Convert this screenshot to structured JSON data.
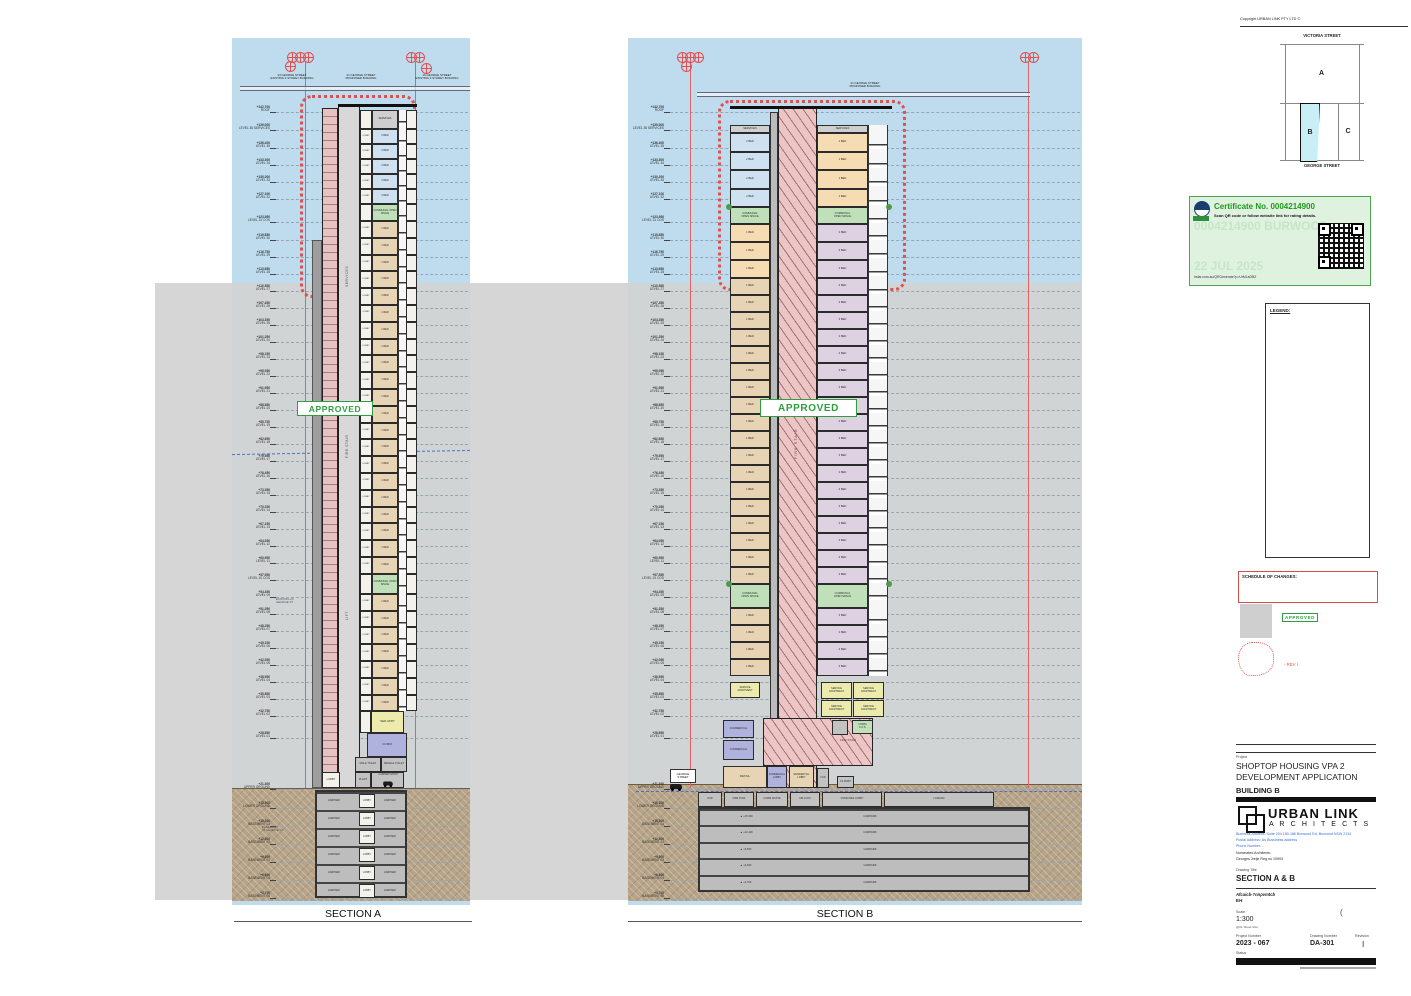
{
  "colors": {
    "approved_green": "#2f9e3f",
    "cert_green": "#1a9c1a",
    "revision_red": "#e0504f",
    "sky": "#bedced",
    "adg_blue": "#5577cc",
    "as1428_red": "#cc4444",
    "solar_orange": "#e8892a"
  },
  "copyright": "Copyright URBAN LINK PTY LTD ©",
  "key_plan": {
    "top_street": "VICTORIA STREET",
    "bottom_street": "GEORGE STREET",
    "block_a": "A",
    "block_b": "B",
    "block_c": "C"
  },
  "certificate": {
    "title": "Certificate No. 0004214900",
    "subtitle": "Scan QR code or follow website link for rating details.",
    "fields": [
      {
        "label": "Assessor name",
        "value": "John Boutros"
      },
      {
        "label": "Accreditation No.",
        "value": "DMN/16/1763"
      },
      {
        "label": "Property Address",
        "value": "28-34 Victoria St,Burwood"
      },
      {
        "label": "",
        "value": "NSW,2134"
      }
    ],
    "link": "hstar.com.au/QRGenerate?p=UrMLaDBZ",
    "watermark1": "0004214900 BURWOOD",
    "watermark2": "22 JUL 2025"
  },
  "legend": {
    "title": "LEGEND:",
    "abbrev": [
      [
        "ELECT",
        "ELECTRICAL CUPBOARD"
      ],
      [
        "ELECT & EV",
        "ELECTRICAL AND\nELECTRIC VEHICLE CUPBOARD"
      ],
      [
        "PRE",
        "PUMP ROOM EXHAUST"
      ],
      [
        "SP",
        "STAIR PRESS"
      ],
      [
        "KE",
        "KITCHEN EXHAUST"
      ],
      [
        "EXH",
        "EXHAUST"
      ],
      [
        "HYD",
        "HYDRAULIC CUPBOARD"
      ],
      [
        "COMMS",
        "COMMUNICATIONS CUPBOARD"
      ],
      [
        "CPE",
        "CAR PARK EXHAUST"
      ],
      [
        "CPS",
        "CAR PARK SUPPLY"
      ],
      [
        "AC",
        "AIR CONDITIONER"
      ],
      [
        "RESI",
        "RESIDENTIAL"
      ],
      [
        "COMM",
        "COMMERCIAL"
      ],
      [
        "SA",
        "SERVICED APARTMENTS"
      ],
      [
        "OSD",
        "ON SITE STORMWATER\nDETENTION"
      ],
      [
        "SRV",
        "SMALL RIGID VEHICLE"
      ],
      [
        "FCR",
        "FIRE CONTROL ROOM"
      ],
      [
        "GC",
        "GARBAGE CHUTE"
      ],
      [
        "SER APRT",
        "SERVICED APARTMENT"
      ],
      [
        "F",
        "FRIDGE"
      ],
      [
        "W",
        "WASHER"
      ],
      [
        "COS",
        "COMMUNAL OPEN SPACE"
      ],
      [
        "HW PLANT",
        "HOT WATER PLANT"
      ]
    ],
    "symbols": [
      [
        "laundry-tub-icon",
        "LAUNDRY TUB"
      ],
      [
        "adaptable-apartment-icon",
        "ADAPTABLE APARTMENT"
      ],
      [
        "liveable-apartment-icon",
        "LIVEABLE APARTMENT"
      ],
      [
        "adg-compliance-icon",
        "ADG COMPLIANCE\nDIMENSIONS"
      ],
      [
        "as1428-circulation-icon",
        "AS 1428.1 CIRCULATION\nDIMENSIONS"
      ],
      [
        "solar-access-icon",
        "SOLAR ACCESS MIN 2 HOURS"
      ]
    ]
  },
  "schedule": {
    "title": "SCHEDULE OF CHANGES:",
    "items": [
      "- AMENDED UNIT MIX.",
      "- COS RELOCATED TO LEVEL 31."
    ],
    "approved": "APPROVED",
    "rev_note": "-  REV I"
  },
  "revisions": {
    "headers": [
      "Rev",
      "Description",
      "Date",
      "App'd"
    ],
    "rows": [
      [
        "I",
        "VPA 2 SUBMISSION",
        "16/07/2025",
        "GJ"
      ],
      [
        "H",
        "VPA 2 SUBMISSION",
        "02/12/2024",
        "JB"
      ],
      [
        "G",
        "SSDA SUBMISSION",
        "23/10/2024",
        "JB"
      ],
      [
        "F",
        "SSDA SUBMISSION",
        "27/08/2024",
        "JB"
      ],
      [
        "E",
        "SSDA SUBMISSION",
        "15/05/2024",
        "JB"
      ],
      [
        "D",
        "SSDA SUBMISSION",
        "03/04/2024",
        "JB"
      ],
      [
        "C",
        "COORDINATION",
        "20/03/2024",
        "JB"
      ],
      [
        "B",
        "SSDA DRP",
        "06/03/2024",
        "JB"
      ],
      [
        "A",
        "SSD BRIEFING",
        "20/12/2023",
        "GJ"
      ]
    ]
  },
  "title_block": {
    "project_label": "Project",
    "project_line1": "SHOPTOP HOUSING VPA 2",
    "project_line2": "DEVELOPMENT APPLICATION",
    "building": "BUILDING B",
    "firm": "URBAN LINK",
    "firm_sub": "A R C H I T E C T S",
    "address1": "Business Address: Suite 204 180-186 Burwood Rd,  Burwood NSW 2134",
    "address2": "Postal Address: As Bussiness address",
    "phone": "Phone Number: -",
    "nominated": "Nominated Architects:",
    "architect": "Georges Jreije Reg no 10993",
    "drawing_title_label": "Drawing Title",
    "drawing_title": "SECTION A & B",
    "code": "Afcaicb-?nnpvmtcb",
    "code2": "EH",
    "scale_label": "Scale",
    "scale": "1:300",
    "sheet_note": "@A1 Sheet Size",
    "bracket": "(",
    "project_number_label": "Project Number",
    "project_number": "2023 - 067",
    "drawing_number_label": "Drawing Number",
    "drawing_number": "DA-301",
    "revision_label": "Revision",
    "revision": "I",
    "status_label": "Status"
  },
  "levels": [
    [
      "+142.700",
      "ROOF",
      112
    ],
    [
      "+139.000",
      "LEVEL 36 SERVICES",
      130
    ],
    [
      "+136.400",
      "LEVEL 35",
      148
    ],
    [
      "+133.300",
      "LEVEL 34",
      165
    ],
    [
      "+130.200",
      "LEVEL 33",
      182
    ],
    [
      "+127.100",
      "LEVEL 32",
      199
    ],
    [
      "+123.950",
      "LEVEL 31 COS",
      222
    ],
    [
      "+119.850",
      "LEVEL 30",
      240
    ],
    [
      "+116.750",
      "LEVEL 29",
      257
    ],
    [
      "+113.650",
      "LEVEL 28",
      274
    ],
    [
      "+110.550",
      "LEVEL 27",
      291
    ],
    [
      "+107.450",
      "LEVEL 26",
      308
    ],
    [
      "+104.350",
      "LEVEL 25",
      325
    ],
    [
      "+101.250",
      "LEVEL 24",
      342
    ],
    [
      "+98.150",
      "LEVEL 23",
      359
    ],
    [
      "+95.050",
      "LEVEL 22",
      376
    ],
    [
      "+91.950",
      "LEVEL 21",
      393
    ],
    [
      "+88.850",
      "LEVEL 20",
      410
    ],
    [
      "+85.750",
      "LEVEL 19",
      427
    ],
    [
      "+82.650",
      "LEVEL 18",
      444
    ],
    [
      "+79.550",
      "LEVEL 17",
      461
    ],
    [
      "+76.450",
      "LEVEL 16",
      478
    ],
    [
      "+73.350",
      "LEVEL 15",
      495
    ],
    [
      "+70.250",
      "LEVEL 14",
      512
    ],
    [
      "+67.150",
      "LEVEL 13",
      529
    ],
    [
      "+64.050",
      "LEVEL 12",
      546
    ],
    [
      "+60.950",
      "LEVEL 11",
      563
    ],
    [
      "+57.550",
      "LEVEL 10 COS",
      580
    ],
    [
      "+54.450",
      "LEVEL 09",
      597
    ],
    [
      "+51.350",
      "LEVEL 08",
      614
    ],
    [
      "+48.250",
      "LEVEL 07",
      631
    ],
    [
      "+45.150",
      "LEVEL 06",
      648
    ],
    [
      "+42.050",
      "LEVEL 05",
      665
    ],
    [
      "+38.950",
      "LEVEL 04",
      682
    ],
    [
      "+35.850",
      "LEVEL 03",
      699
    ],
    [
      "+32.750",
      "LEVEL 02",
      716
    ],
    [
      "+28.850",
      "LEVEL 01",
      738
    ],
    [
      "+21.300",
      "UPPER GROUND",
      789
    ],
    [
      "+18.300",
      "LOWER GROUND",
      808
    ],
    [
      "+15.300",
      "BASEMENT 01",
      826
    ],
    [
      "+12.400",
      "BASEMENT 02",
      844
    ],
    [
      "+9.500",
      "BASEMENT 03",
      862
    ],
    [
      "+6.600",
      "BASEMENT 04",
      880
    ],
    [
      "+3.700",
      "BASEMENT 05",
      898
    ]
  ],
  "section_a": {
    "title": "SECTION A",
    "approved": "APPROVED",
    "street_segments": [
      [
        "23 GEORGE STREET",
        "EXISTING 2 STOREY BUILDING"
      ],
      [
        "21 GEORGE STREET",
        "PROPOSED BUILDING"
      ],
      [
        "19 GEORGE STREET",
        "EXISTING 3 STOREY BUILDING"
      ]
    ],
    "core_labels": [
      "SERVICES",
      "FIRE STAIR",
      "LIFT"
    ],
    "existing_note": "EXISTING 23\nGEORGE ST",
    "basement_note": "BASEMENT\n23 GEORGE ST",
    "floor_bands": [
      {
        "count": 1,
        "h": 19,
        "lobby": "",
        "unit": "SERVICES",
        "type": "svc"
      },
      {
        "count": 5,
        "h": 15,
        "lobby": "LOBBY",
        "unit": "2 BED",
        "type": "blue"
      },
      {
        "count": 1,
        "h": 17,
        "lobby": "",
        "unit": "COMMUNAL OPEN SPACE",
        "type": "green"
      },
      {
        "count": 21,
        "h": 16.8,
        "lobby": "LOBBY",
        "unit": "1 BED",
        "type": "tan"
      },
      {
        "count": 1,
        "h": 20,
        "lobby": "",
        "unit": "COMMUNAL OPEN SPACE",
        "type": "green"
      },
      {
        "count": 7,
        "h": 16.8,
        "lobby": "LOBBY",
        "unit": "1 BED",
        "type": "tan"
      }
    ],
    "podium": {
      "ser_aprt": "SER APRT",
      "comm": "COMM",
      "male_toilet": "MALE TOILET",
      "female_toilet": "FEMALE TOILET",
      "lobby": "LOBBY",
      "plant": "PLANT",
      "carpark_entry": "CARPARK ENTRY"
    },
    "basement": {
      "carpark": "CARPARK",
      "lobby": "LOBBY",
      "rows": 5
    }
  },
  "section_b": {
    "title": "SECTION B",
    "approved": "APPROVED",
    "street_label1": "21 GEORGE STREET",
    "street_label2": "PROPOSED BUILDING",
    "george_street": "GEORGE\nSTREET",
    "core_label": "FIRE STAIR",
    "floor_bands": [
      {
        "count": 1,
        "h": 8,
        "left": "SERVICES",
        "ltype": "svc",
        "right": "SERVICES",
        "rtype": "svc"
      },
      {
        "count": 4,
        "h": 18.5,
        "left": "2 BED",
        "ltype": "blue",
        "right": "1 BED",
        "rtype": "orange"
      },
      {
        "count": 1,
        "h": 17,
        "left": "COMMUNAL\nOPEN SPACE",
        "ltype": "green",
        "right": "COMMUNAL\nOPEN SPACE",
        "rtype": "green"
      },
      {
        "count": 3,
        "h": 18,
        "left": "1 BED",
        "ltype": "orange",
        "right": "3 BED",
        "rtype": "lav"
      },
      {
        "count": 18,
        "h": 17,
        "left": "1 BED",
        "ltype": "tan",
        "right": "3 BED",
        "rtype": "lav"
      },
      {
        "count": 1,
        "h": 24,
        "left": "COMMUNAL\nOPEN SPACE",
        "ltype": "green",
        "right": "COMMUNAL\nOPEN SPACE",
        "rtype": "green"
      },
      {
        "count": 4,
        "h": 17,
        "left": "1 BED",
        "ltype": "tan",
        "right": "3 BED",
        "rtype": "lav"
      }
    ],
    "podium": {
      "service_apartment": "SERVICE\nAPARTMENT",
      "commercial": "COMMERCIAL",
      "fire_stair": "FIRE STAIR",
      "comm_cos": "COMM\nC.O.S.",
      "retail": "RETAIL",
      "commercial_lobby": "COMMERCIAL\nLOBBY",
      "residential_lobby": "RESIDENTIAL\nLOBBY",
      "fcr": "FCR",
      "fs_pump": "FS PUMP"
    },
    "lower_ground_cells": [
      "OSD",
      "FIRE TANK",
      "COMM WASTE",
      "AIR LOCK",
      "COMM RES LOBBY",
      "LOADING"
    ],
    "basement": {
      "carpark": "CARPARK",
      "values": [
        "+15.300",
        "+12.400",
        "+9.500",
        "+6.600",
        "+3.700"
      ]
    }
  }
}
